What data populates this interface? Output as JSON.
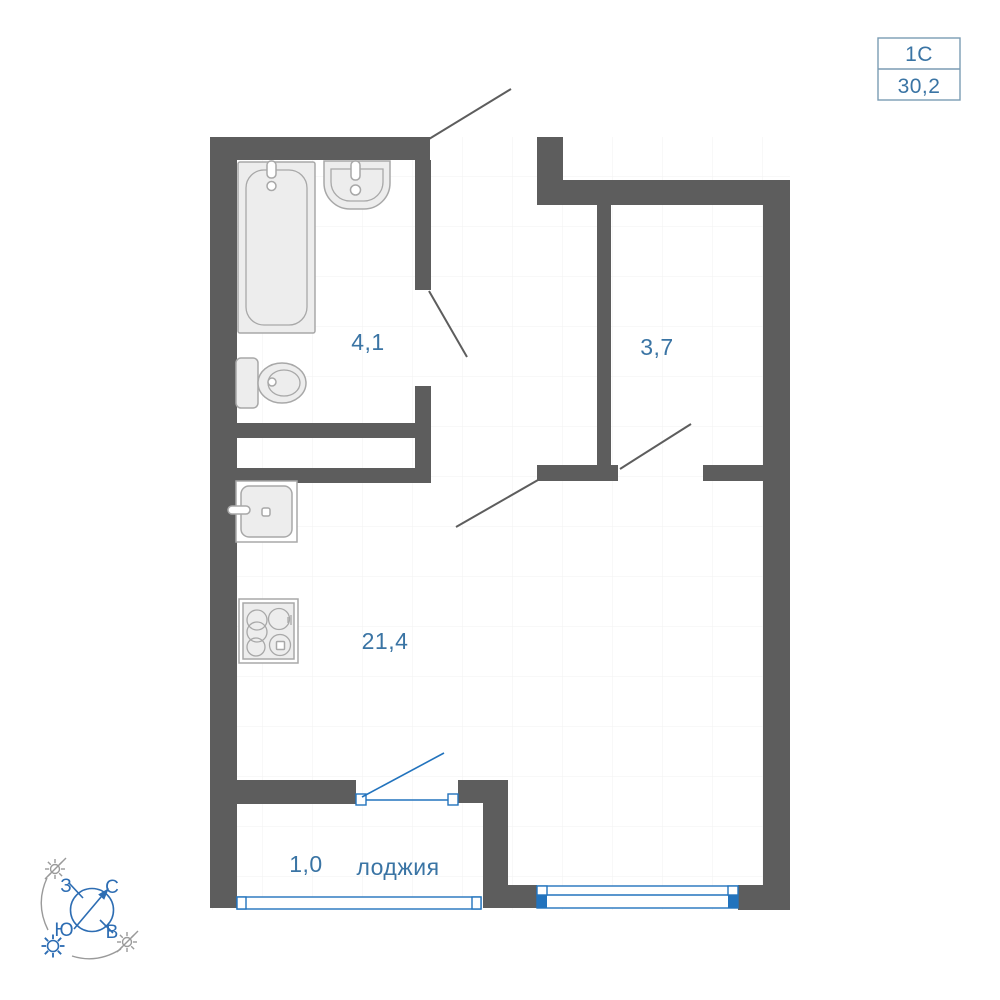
{
  "colors": {
    "wall": "#5d5d5d",
    "fixture_fill": "#ededed",
    "fixture_stroke": "#a8a8a8",
    "label_blue": "#3a74a4",
    "window_blue": "#2273bd",
    "compass_blue": "#2d6db3",
    "muted_gray": "#9a9a9a",
    "grid_line": "#f2f2f2",
    "frame_border": "#7b9cb3"
  },
  "header": {
    "plan_code": "1С",
    "total_area": "30,2"
  },
  "rooms": {
    "bathroom": {
      "area": "4,1"
    },
    "hallway": {
      "area": "3,7"
    },
    "living_kitchen": {
      "area": "21,4"
    },
    "loggia": {
      "area": "1,0",
      "name": "лоджия"
    }
  },
  "compass": {
    "north": "С",
    "south": "Ю",
    "west": "З",
    "east": "В"
  }
}
